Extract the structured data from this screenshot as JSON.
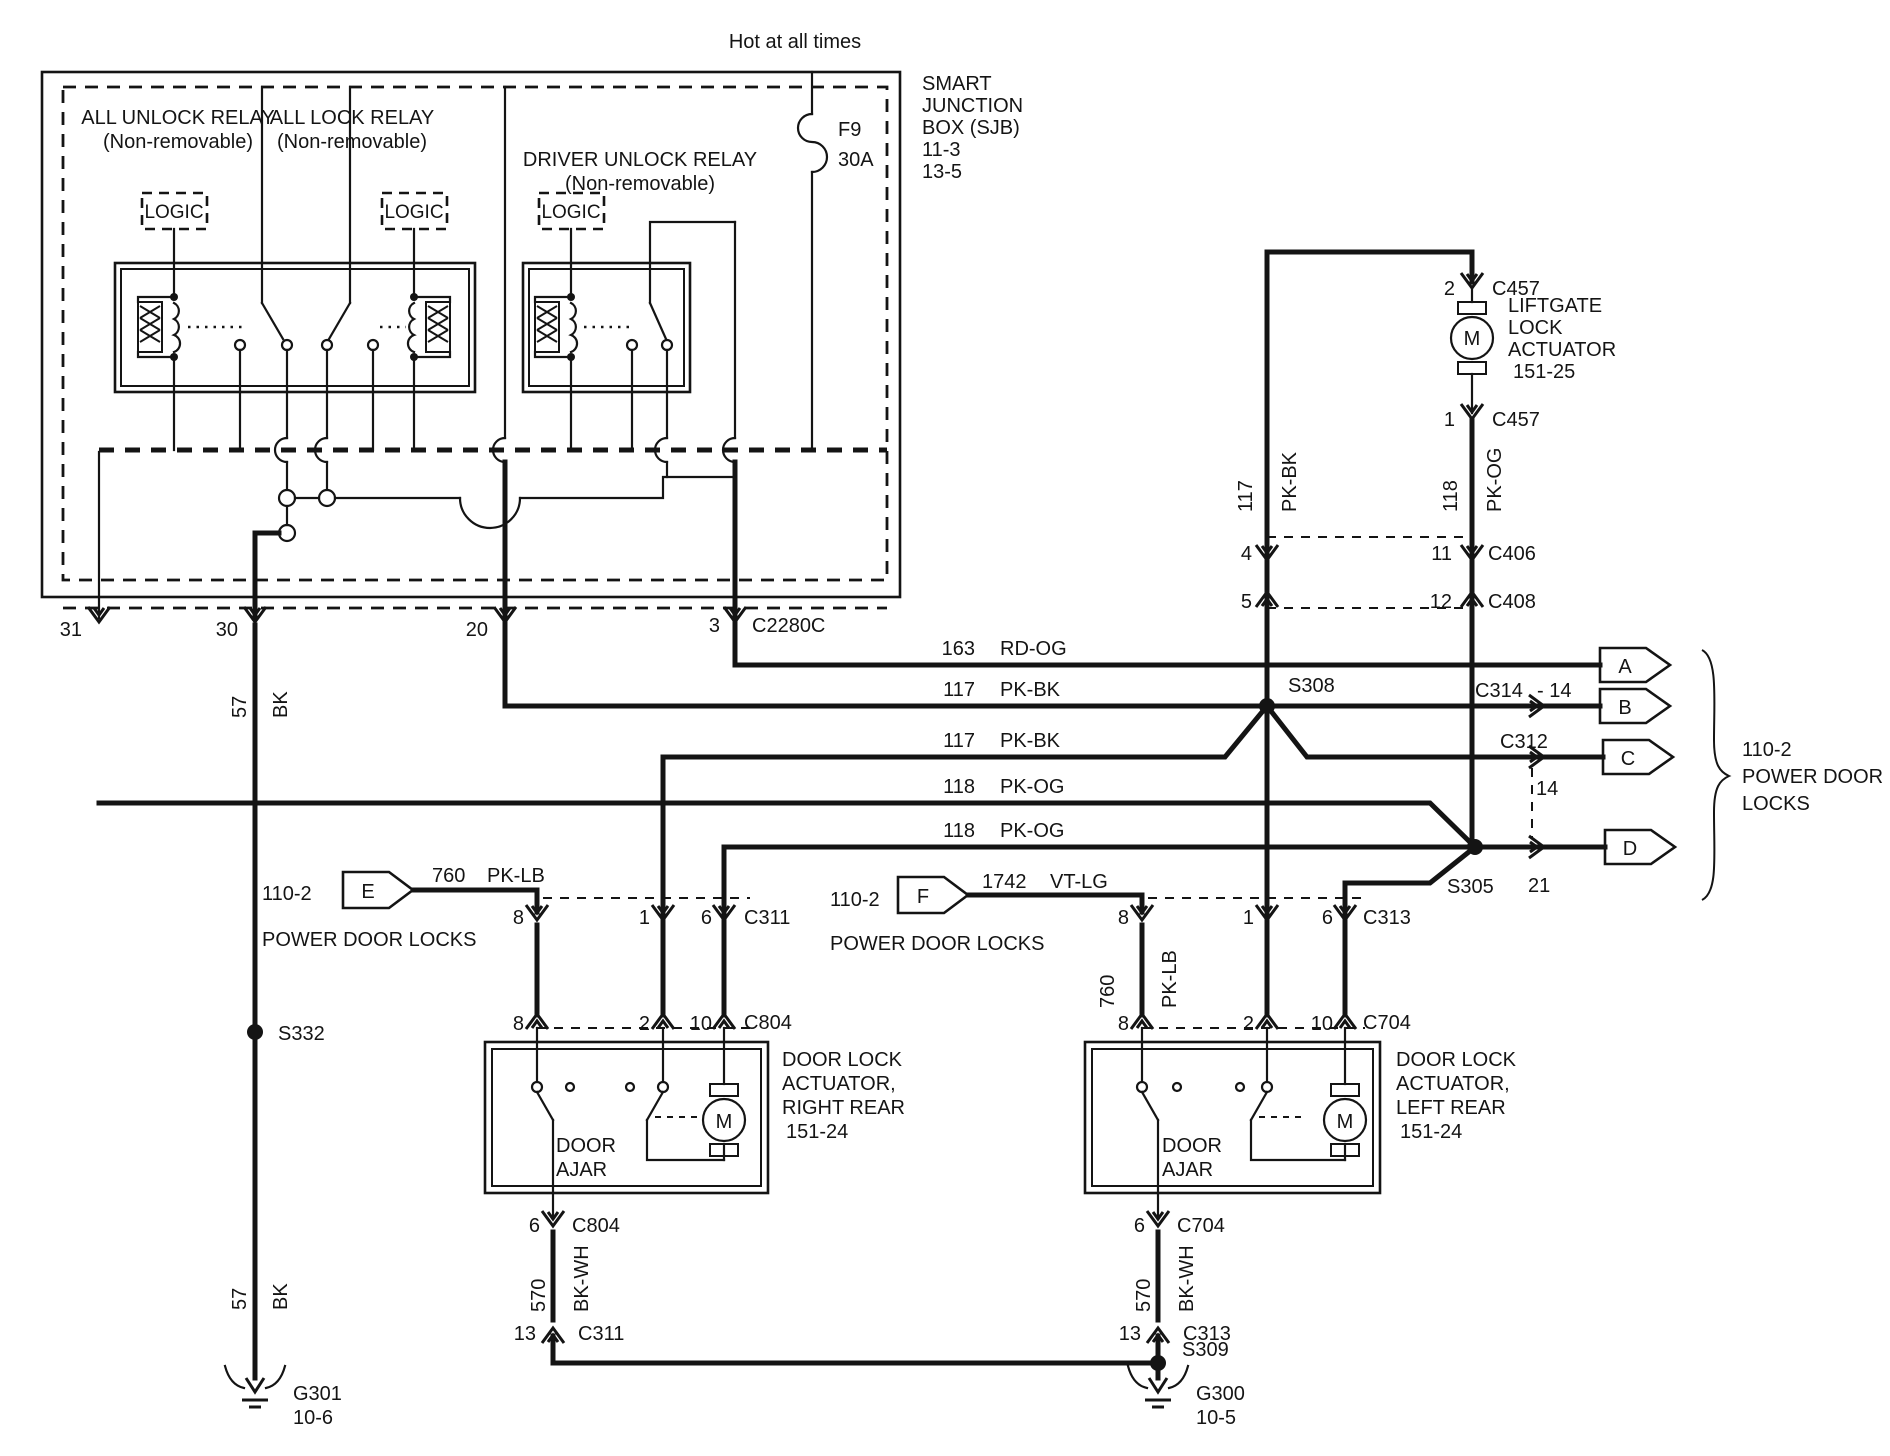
{
  "title": "Hot at all times",
  "sjb": {
    "l1": "SMART",
    "l2": "JUNCTION",
    "l3": "BOX (SJB)",
    "l4": "11-3",
    "l5": "13-5"
  },
  "fuse": {
    "name": "F9",
    "amp": "30A"
  },
  "relay1": {
    "t": "ALL UNLOCK RELAY",
    "s": "(Non-removable)",
    "logic": "LOGIC"
  },
  "relay2": {
    "t": "ALL LOCK RELAY",
    "s": "(Non-removable)",
    "logic": "LOGIC"
  },
  "relay3": {
    "t": "DRIVER UNLOCK RELAY",
    "s": "(Non-removable)",
    "logic": "LOGIC"
  },
  "pins": {
    "p31": "31",
    "p30": "30",
    "p20": "20",
    "p3": "3",
    "c2280c": "C2280C"
  },
  "rows": [
    {
      "n": "163",
      "c": "RD-OG"
    },
    {
      "n": "117",
      "c": "PK-BK"
    },
    {
      "n": "117",
      "c": "PK-BK"
    },
    {
      "n": "118",
      "c": "PK-OG"
    },
    {
      "n": "118",
      "c": "PK-OG"
    }
  ],
  "vert": {
    "n117": "117",
    "c117": "PK-BK",
    "n118": "118",
    "c118": "PK-OG"
  },
  "splice": {
    "s308": "S308",
    "s305": "S305",
    "s332": "S332",
    "s309": "S309"
  },
  "conn": {
    "a": "A",
    "b": "B",
    "c": "C",
    "d": "D",
    "e": "E",
    "f": "F",
    "c314": "C314",
    "c314p": "- 14",
    "c312": "C312",
    "p14": "14",
    "p21": "21"
  },
  "pdl": {
    "ref": "110-2",
    "l1": "POWER DOOR",
    "l2": "LOCKS",
    "full": "POWER DOOR LOCKS"
  },
  "lift": {
    "p2": "2",
    "p1": "1",
    "c457a": "C457",
    "c457b": "C457",
    "l1": "LIFTGATE",
    "l2": "LOCK",
    "l3": "ACTUATOR",
    "l4": "151-25",
    "m": "M"
  },
  "c406": {
    "p4": "4",
    "p11": "11",
    "name": "C406",
    "p5": "5",
    "p12": "12",
    "c408": "C408"
  },
  "ewire": {
    "n": "760",
    "c": "PK-LB"
  },
  "fwire": {
    "n": "1742",
    "c": "VT-LG",
    "n2": "760",
    "c2": "PK-LB"
  },
  "bk_up": {
    "n": "57",
    "c": "BK"
  },
  "bk_dn": {
    "n": "57",
    "c": "BK"
  },
  "rr": {
    "p8": "8",
    "p1": "1",
    "p6": "6",
    "c311": "C311",
    "p8b": "8",
    "p2": "2",
    "p10": "10",
    "c804": "C804",
    "t1": "DOOR LOCK",
    "t2": "ACTUATOR,",
    "t3": "RIGHT REAR",
    "t4": "151-24",
    "d1": "DOOR",
    "d2": "AJAR",
    "m": "M",
    "p6b": "6",
    "c804b": "C804",
    "wn": "570",
    "wc": "BK-WH",
    "p13": "13",
    "c311b": "C311"
  },
  "lr": {
    "p8": "8",
    "p1": "1",
    "p6": "6",
    "c313": "C313",
    "p8b": "8",
    "p2": "2",
    "p10": "10",
    "c704": "C704",
    "t1": "DOOR LOCK",
    "t2": "ACTUATOR,",
    "t3": "LEFT REAR",
    "t4": "151-24",
    "d1": "DOOR",
    "d2": "AJAR",
    "m": "M",
    "p6b": "6",
    "c704b": "C704",
    "wn": "570",
    "wc": "BK-WH",
    "p13": "13",
    "c313b": "C313"
  },
  "gnd": {
    "g301": "G301",
    "g301p": "10-6",
    "g300": "G300",
    "g300p": "10-5"
  }
}
